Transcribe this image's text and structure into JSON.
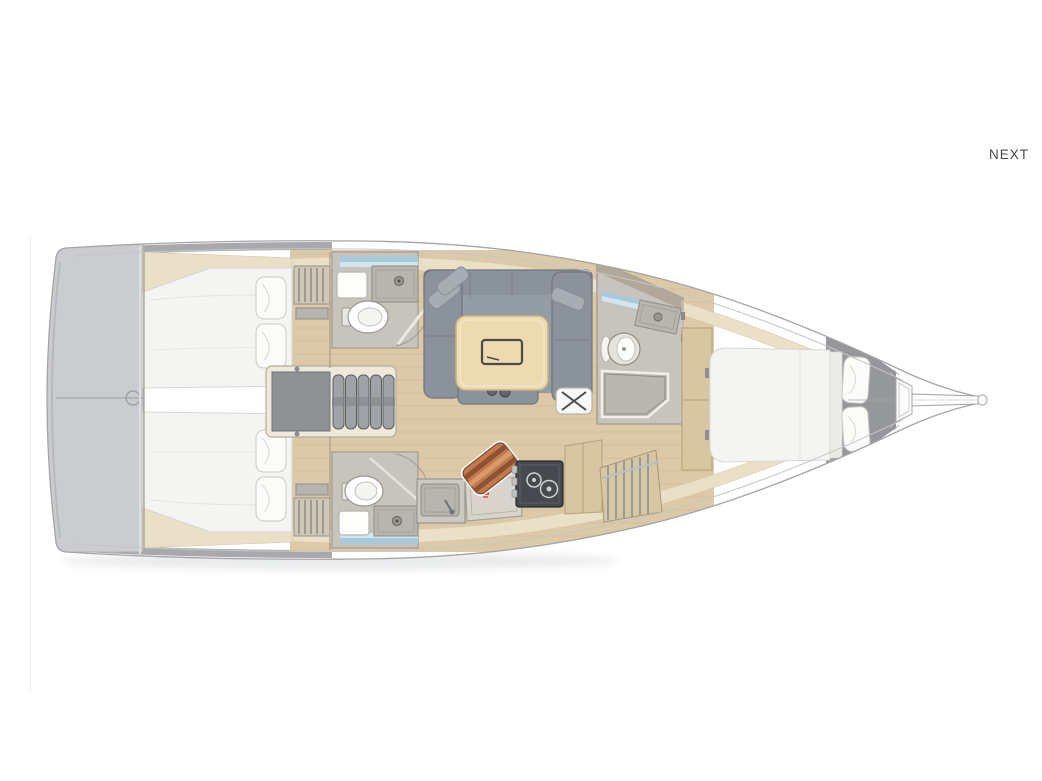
{
  "nav": {
    "next_label": "NEXT"
  },
  "floorplan": {
    "description": "sailboat-interior-top-view",
    "colors": {
      "hull-line": "#a5a5a5",
      "transom": "#caccd0",
      "floor": "#dcc9a8",
      "plank": "#c9b58d",
      "deck-band": "#eadfc7",
      "wall": "#c7c4bd",
      "wall-edge": "#a39a8a",
      "bed": "#f4f4f2",
      "pillow": "#fbfbfa",
      "sofa": "#8a929b",
      "sofa-edge": "#6e757d",
      "cushion": "#a7adb4",
      "table": "#ecdab0",
      "table-edge": "#c9b183",
      "wood-cabinet": "#d7c6a2",
      "window": "#a9c8da",
      "window-light": "#d3e6f0",
      "fixture": "#b7b5ae",
      "stove": "#46494d",
      "steps": "#9fa2a6",
      "copper": "#c07a4e",
      "copper-dark": "#8e5233",
      "copper-light": "#d89a6a",
      "accent-red": "#c0392b",
      "dark-hull": "#95979b",
      "side-strip": "#a7a9ac"
    }
  }
}
